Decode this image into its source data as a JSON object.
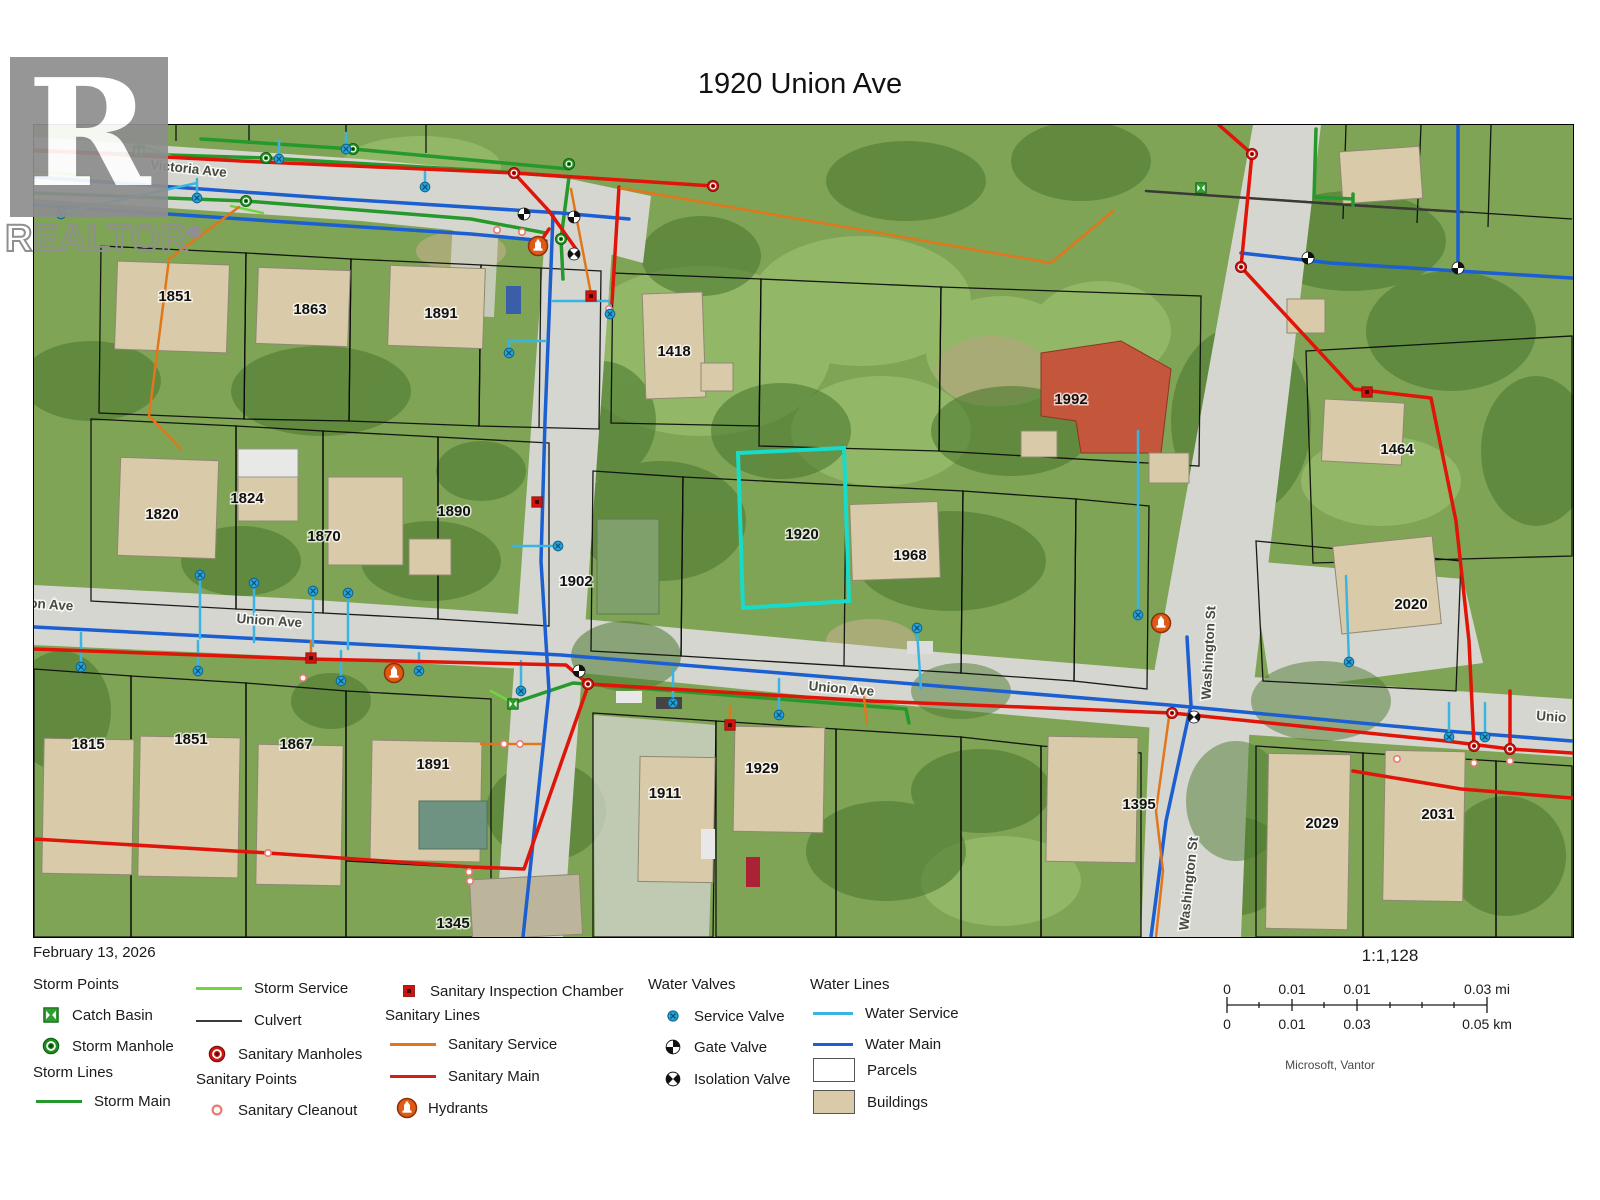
{
  "title": "1920 Union Ave",
  "logo": {
    "name": "REALTOR",
    "registered": "®"
  },
  "legend": {
    "date": "February 13, 2026",
    "storm_points": "Storm Points",
    "catch_basin": "Catch Basin",
    "storm_manhole": "Storm Manhole",
    "storm_lines": "Storm Lines",
    "storm_main": "Storm Main",
    "storm_service": "Storm Service",
    "culvert": "Culvert",
    "sanitary_manholes": "Sanitary Manholes",
    "sanitary_points": "Sanitary Points",
    "sanitary_cleanout": "Sanitary Cleanout",
    "sanitary_inspection_chamber": "Sanitary Inspection Chamber",
    "sanitary_lines": "Sanitary Lines",
    "sanitary_service": "Sanitary Service",
    "sanitary_main": "Sanitary Main",
    "hydrants": "Hydrants",
    "water_valves": "Water Valves",
    "service_valve": "Service Valve",
    "gate_valve": "Gate Valve",
    "isolation_valve": "Isolation Valve",
    "water_lines": "Water Lines",
    "water_service": "Water Service",
    "water_main": "Water Main",
    "parcels": "Parcels",
    "buildings": "Buildings"
  },
  "scalebar": {
    "ratio": "1:1,128",
    "mi": [
      "0",
      "0.01",
      "0.01",
      "0.03 mi"
    ],
    "km": [
      "0",
      "0.01",
      "0.03",
      "0.05 km"
    ],
    "attribution": "Microsoft, Vantor"
  },
  "colors": {
    "stormmain": "#27982b",
    "stormserv": "#6fd63f",
    "culvert": "#3a3a35",
    "sanmain": "#e01408",
    "sanserv": "#e2761b",
    "watermain": "#1b5fd0",
    "waterserv": "#3ab5e2",
    "building": "#d9cbaa",
    "highlight": "#17dcca"
  },
  "map_overlay": {
    "street_labels": [
      {
        "text": "Victoria Ave",
        "x": 187,
        "y": 172,
        "rot": 6
      },
      {
        "text": "on Ave",
        "x": 50,
        "y": 608,
        "rot": 4
      },
      {
        "text": "Union Ave",
        "x": 268,
        "y": 624,
        "rot": 4
      },
      {
        "text": "Union Ave",
        "x": 840,
        "y": 692,
        "rot": 5
      },
      {
        "text": "Unio",
        "x": 1550,
        "y": 720,
        "rot": 4
      },
      {
        "text": "Washington St",
        "x": 1212,
        "y": 652,
        "rot": -87
      },
      {
        "text": "Washington St",
        "x": 1192,
        "y": 883,
        "rot": -84
      }
    ],
    "parcel_labels": [
      {
        "text": "1851",
        "x": 174,
        "y": 295
      },
      {
        "text": "1863",
        "x": 309,
        "y": 308
      },
      {
        "text": "1891",
        "x": 440,
        "y": 312
      },
      {
        "text": "1418",
        "x": 673,
        "y": 350
      },
      {
        "text": "1992",
        "x": 1070,
        "y": 398
      },
      {
        "text": "1464",
        "x": 1396,
        "y": 448
      },
      {
        "text": "1820",
        "x": 161,
        "y": 513
      },
      {
        "text": "1824",
        "x": 246,
        "y": 497
      },
      {
        "text": "1870",
        "x": 323,
        "y": 535
      },
      {
        "text": "1890",
        "x": 453,
        "y": 510
      },
      {
        "text": "1902",
        "x": 575,
        "y": 580
      },
      {
        "text": "1920",
        "x": 801,
        "y": 533
      },
      {
        "text": "1968",
        "x": 909,
        "y": 554
      },
      {
        "text": "2020",
        "x": 1410,
        "y": 603
      },
      {
        "text": "1815",
        "x": 87,
        "y": 743
      },
      {
        "text": "1851",
        "x": 190,
        "y": 738
      },
      {
        "text": "1867",
        "x": 295,
        "y": 743
      },
      {
        "text": "1891",
        "x": 432,
        "y": 763
      },
      {
        "text": "1911",
        "x": 664,
        "y": 792
      },
      {
        "text": "1929",
        "x": 761,
        "y": 767
      },
      {
        "text": "1345",
        "x": 452,
        "y": 922
      },
      {
        "text": "1395",
        "x": 1138,
        "y": 803
      },
      {
        "text": "2029",
        "x": 1321,
        "y": 822
      },
      {
        "text": "2031",
        "x": 1437,
        "y": 813
      }
    ],
    "points": [
      [
        "storm-manhole",
        265,
        157
      ],
      [
        "storm-manhole",
        352,
        148
      ],
      [
        "storm-manhole",
        568,
        163
      ],
      [
        "storm-manhole",
        245,
        200
      ],
      [
        "storm-manhole",
        560,
        238
      ],
      [
        "sanitary-manhole",
        513,
        172
      ],
      [
        "sanitary-manhole",
        712,
        185
      ],
      [
        "sanitary-manhole",
        1251,
        153
      ],
      [
        "sanitary-manhole",
        1240,
        266
      ],
      [
        "sanitary-manhole",
        587,
        683
      ],
      [
        "sanitary-manhole",
        1171,
        712
      ],
      [
        "sanitary-manhole",
        1473,
        745
      ],
      [
        "sanitary-manhole",
        1509,
        748
      ],
      [
        "catch-basin",
        138,
        150
      ],
      [
        "catch-basin",
        1200,
        187
      ],
      [
        "catch-basin",
        512,
        703
      ],
      [
        "inspection-chamber",
        310,
        657
      ],
      [
        "inspection-chamber",
        590,
        295
      ],
      [
        "inspection-chamber",
        536,
        501
      ],
      [
        "inspection-chamber",
        729,
        724
      ],
      [
        "inspection-chamber",
        1366,
        391
      ],
      [
        "cleanout",
        496,
        229
      ],
      [
        "cleanout",
        521,
        231
      ],
      [
        "cleanout",
        608,
        308
      ],
      [
        "cleanout",
        302,
        677
      ],
      [
        "cleanout",
        503,
        743
      ],
      [
        "cleanout",
        519,
        743
      ],
      [
        "cleanout",
        267,
        852
      ],
      [
        "cleanout",
        468,
        871
      ],
      [
        "cleanout",
        469,
        880
      ],
      [
        "cleanout",
        1473,
        762
      ],
      [
        "cleanout",
        1509,
        760
      ],
      [
        "cleanout",
        1396,
        758
      ],
      [
        "hydrant",
        537,
        245
      ],
      [
        "hydrant",
        393,
        672
      ],
      [
        "hydrant",
        1160,
        622
      ],
      [
        "gate-valve",
        523,
        213
      ],
      [
        "gate-valve",
        573,
        216
      ],
      [
        "gate-valve",
        578,
        670
      ],
      [
        "gate-valve",
        1307,
        257
      ],
      [
        "gate-valve",
        1457,
        267
      ],
      [
        "isolation-valve",
        573,
        253
      ],
      [
        "isolation-valve",
        1193,
        716
      ],
      [
        "service-valve",
        60,
        213
      ],
      [
        "service-valve",
        196,
        197
      ],
      [
        "service-valve",
        278,
        158
      ],
      [
        "service-valve",
        345,
        148
      ],
      [
        "service-valve",
        424,
        186
      ],
      [
        "service-valve",
        609,
        313
      ],
      [
        "service-valve",
        508,
        352
      ],
      [
        "service-valve",
        557,
        545
      ],
      [
        "service-valve",
        80,
        666
      ],
      [
        "service-valve",
        199,
        574
      ],
      [
        "service-valve",
        253,
        582
      ],
      [
        "service-valve",
        312,
        590
      ],
      [
        "service-valve",
        347,
        592
      ],
      [
        "service-valve",
        197,
        670
      ],
      [
        "service-valve",
        340,
        680
      ],
      [
        "service-valve",
        418,
        670
      ],
      [
        "service-valve",
        520,
        690
      ],
      [
        "service-valve",
        672,
        702
      ],
      [
        "service-valve",
        778,
        714
      ],
      [
        "service-valve",
        916,
        627
      ],
      [
        "service-valve",
        1137,
        614
      ],
      [
        "service-valve",
        1348,
        661
      ],
      [
        "service-valve",
        1448,
        736
      ],
      [
        "service-valve",
        1484,
        736
      ]
    ]
  }
}
